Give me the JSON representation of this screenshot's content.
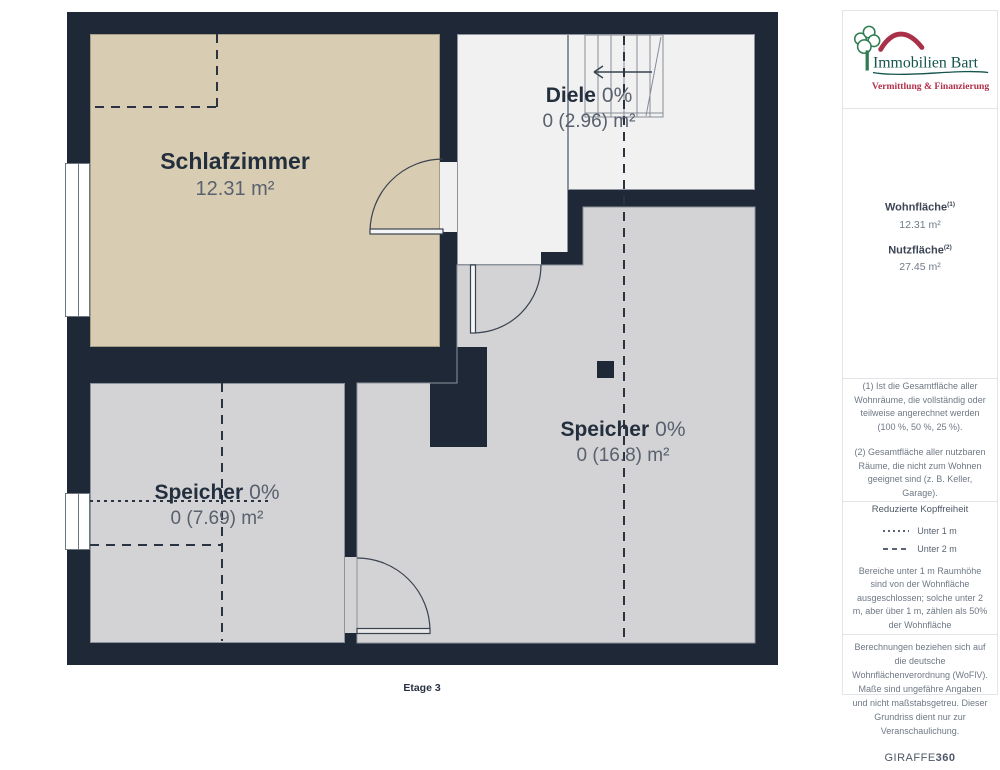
{
  "colors": {
    "wall": "#1e2836",
    "room_beige": "#d8cdb2",
    "room_gray": "#d3d3d5",
    "room_white": "#f1f1f2",
    "logo_green": "#15544d",
    "logo_red": "#b13049"
  },
  "plan": {
    "floor_label": "Etage 3",
    "rooms": {
      "schlafzimmer": {
        "name": "Schlafzimmer",
        "area": "12.31 m²"
      },
      "diele": {
        "name": "Diele",
        "percent": "0%",
        "area": "0 (2.96) m²"
      },
      "speicher_gross": {
        "name": "Speicher",
        "percent": "0%",
        "area": "0 (16.8) m²"
      },
      "speicher_klein": {
        "name": "Speicher",
        "percent": "0%",
        "area": "0 (7.69) m²"
      }
    }
  },
  "sidebar": {
    "logo": {
      "company": "Immobilien Bart",
      "tagline": "Vermittlung & Finanzierung"
    },
    "areas": {
      "wohnflaeche_label": "Wohnfläche",
      "wohnflaeche_sup": "(1)",
      "wohnflaeche_value": "12.31 m²",
      "nutzflaeche_label": "Nutzfläche",
      "nutzflaeche_sup": "(2)",
      "nutzflaeche_value": "27.45 m²"
    },
    "footnotes": {
      "f1": "(1) Ist die Gesamtfläche aller Wohnräume, die vollständig oder teilweise angerechnet werden (100 %, 50 %, 25 %).",
      "f2": "(2) Gesamtfläche aller nutzbaren Räume, die nicht zum Wohnen geeignet sind (z. B. Keller, Garage)."
    },
    "headroom": {
      "title": "Reduzierte Kopffreiheit",
      "legend": [
        {
          "label": "Unter 1 m"
        },
        {
          "label": "Unter 2 m"
        }
      ],
      "note": "Bereiche unter 1 m Raumhöhe sind von der Wohnfläche ausgeschlossen; solche unter 2 m, aber über 1 m, zählen als 50% der Wohnfläche"
    },
    "disclaimer": "Berechnungen beziehen sich auf die deutsche Wohnflächenverordnung (WoFlV). Maße sind ungefähre Angaben und nicht maßstabsgetreu. Dieser Grundriss dient nur zur Veranschaulichung.",
    "brand": {
      "name": "GIRAFFE",
      "suffix": "360"
    }
  }
}
